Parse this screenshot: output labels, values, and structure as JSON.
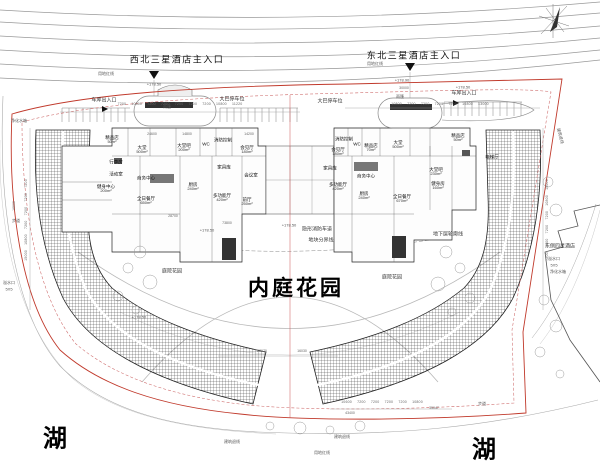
{
  "colors": {
    "boundary_red": "#c0392b",
    "centerline_red": "#cc5555",
    "line_dark": "#222222",
    "line_gray": "#999999"
  },
  "entrances": {
    "northwest": "西北三星酒店主入口",
    "northeast": "东北三星酒店主入口"
  },
  "labels": {
    "red_line": "用地红线",
    "setback_line": "建筑退线",
    "walkway": "步道",
    "bus_parking": "大巴停车位",
    "garage_entrance": "车库出入口",
    "canopy": "雨篷",
    "fire_lane": "隐形消防车道",
    "parcel_line": "地块分界线",
    "basement_outline": "地下层轮廓线",
    "courtyard_garden": "庭院花园",
    "inner_garden": "内庭花园",
    "lake": "湖",
    "east_hotel": "东侧四星酒店",
    "overflow": "溢水口",
    "overflow_size": "5X5",
    "water_tank": "净化水箱"
  },
  "elevation_marks": {
    "e17850": "+178.50",
    "e17890": "+178.90"
  },
  "rooms_left": [
    {
      "name": "精品店",
      "area": "50m²"
    },
    {
      "name": "大堂",
      "area": "500m²"
    },
    {
      "name": "大堂吧",
      "area": "200m²"
    },
    {
      "name": "会见厅",
      "area": "180m²"
    },
    {
      "name": "WC",
      "area": ""
    },
    {
      "name": "消防控制",
      "area": ""
    },
    {
      "name": "行李房",
      "area": ""
    },
    {
      "name": "活动室",
      "area": ""
    },
    {
      "name": "健身中心",
      "area": "200m²"
    },
    {
      "name": "商务中心",
      "area": ""
    },
    {
      "name": "全日餐厅",
      "area": "650m²"
    },
    {
      "name": "厨房",
      "area": "240m²"
    },
    {
      "name": "多功能厅",
      "area": "420m²"
    },
    {
      "name": "前厅",
      "area": "250m²"
    },
    {
      "name": "家具库",
      "area": ""
    },
    {
      "name": "会议室",
      "area": ""
    }
  ],
  "rooms_right": [
    {
      "name": "消防控制",
      "area": ""
    },
    {
      "name": "WC",
      "area": ""
    },
    {
      "name": "精品店",
      "area": "70m²"
    },
    {
      "name": "大堂",
      "area": "500m²"
    },
    {
      "name": "会见厅",
      "area": "180m²"
    },
    {
      "name": "家具库",
      "area": ""
    },
    {
      "name": "商务中心",
      "area": ""
    },
    {
      "name": "多功能厅",
      "area": "420m²"
    },
    {
      "name": "厨房",
      "area": "240m²"
    },
    {
      "name": "全日餐厅",
      "area": "670m²"
    },
    {
      "name": "大堂吧",
      "area": "230m²"
    },
    {
      "name": "健身房",
      "area": "160m²"
    },
    {
      "name": "精品店",
      "area": "50m²"
    },
    {
      "name": "电梯厅",
      "area": ""
    }
  ],
  "dims": {
    "top_left_row": "7200 10800 7200 7200 7200 7200 7200 10800 11220",
    "top_right_row": "10800 7200 7200 7200 7200 10800 13000",
    "left_col": "15000 10800 7200 7200 7200 7200",
    "right_col": "7200 7200 7200 7200 10800 15000",
    "bottom_row": "10600 7200 7200 7200 7200 10800",
    "d22070": "22070",
    "d16030": "16030",
    "d43400": "43400",
    "d35047": "35047",
    "d24600": "24600",
    "d14800": "14800",
    "d14200": "14200",
    "d28700": "28700",
    "d73800": "73800",
    "d30000": "30000",
    "d10000": "10000"
  }
}
